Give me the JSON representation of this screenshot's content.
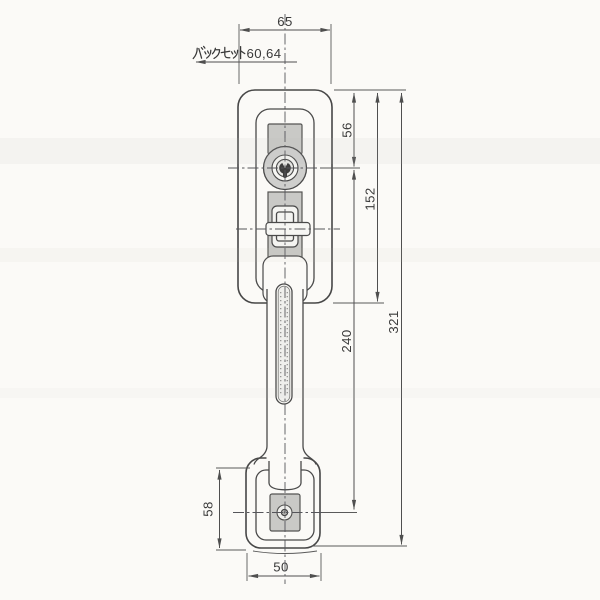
{
  "drawing": {
    "title_note": "door handle lockset technical drawing",
    "labels": {
      "backset_full": "バックセット60,64",
      "backset_value_suffix": "60,64"
    },
    "dimensions": {
      "top_width": "65",
      "cylinder_offset": "56",
      "plate_height": "152",
      "grip_span": "240",
      "overall_length": "321",
      "base_height": "58",
      "base_width": "50"
    },
    "colors": {
      "paper": "#fbfaf7",
      "line": "#4a4a4a",
      "shading": "#c9c9c6",
      "text": "#3a3a3a"
    }
  }
}
